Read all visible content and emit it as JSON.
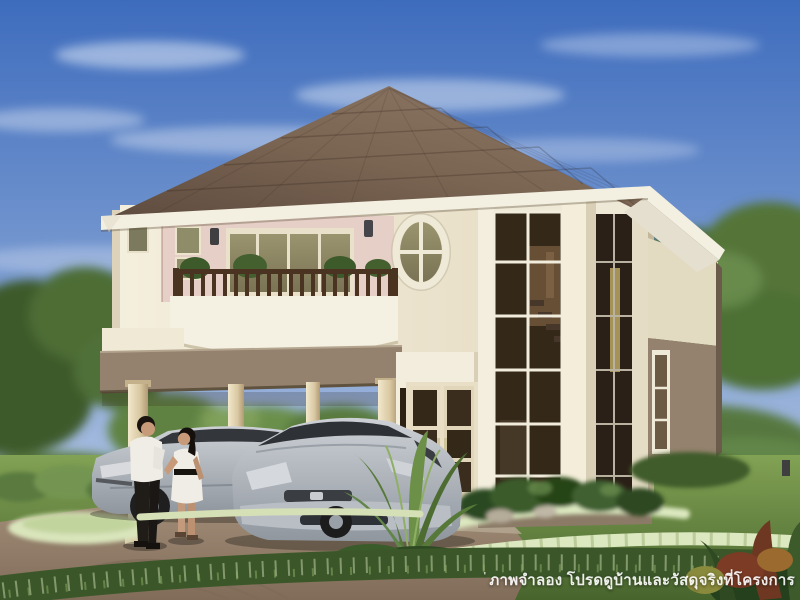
{
  "watermark": {
    "mark": "'",
    "text": "ภาพจำลอง โปรดดูบ้านและวัสดุจริงที่โครงการ"
  },
  "scene": {
    "setting": "Daytime exterior rendering of a two-story detached house with carport",
    "objects": {
      "sky": "blue sky with thin white clouds",
      "roof": "brown hipped tile roof with white fascia and eaves",
      "upper-walls": "cream walls with pink balcony recess",
      "lower-walls": "taupe stucco base",
      "balcony": "white curved parapet with dark wood railing and potted plants",
      "oval-window": "oval window with white cross muntins",
      "corner-window-bay": "two-story chamfered corner bay with dark glazing and visible staircase",
      "carport": "flat-roof carport on round cream columns",
      "front-door": "double doors with dark glass panes",
      "sedan-car": "silver sedan parked under carport",
      "hatchback-car": "silver hatchback parked in driveway",
      "man": "man in white shirt and black trousers",
      "woman": "woman in white dress with black belt",
      "garden": "lawn, trimmed hedges, white flower borders, palm and tropical plants",
      "trees": "green trees surrounding the property"
    }
  },
  "palette": {
    "sky-top": "#3e6cbd",
    "sky-mid": "#84a3d4",
    "sky-low": "#c9d6ea",
    "cloud-white": "#eef3fb",
    "roof-dark": "#554439",
    "roof-mid": "#7a6452",
    "roof-light": "#8d7765",
    "fascia-white": "#f3efe1",
    "wall-cream": "#f1ead7",
    "wall-cream-shade": "#ddd3bb",
    "wall-pink": "#e6cfc6",
    "wall-taupe": "#94826e",
    "wall-taupe-dark": "#7d6c5a",
    "column-cream": "#ecdfbe",
    "glass-olive": "#8f8c6a",
    "glass-dark": "#342819",
    "glass-stair": "#6b5338",
    "rail-wood": "#4b3322",
    "lawn-light": "#82a254",
    "lawn-dark": "#47642d",
    "tree-dark": "#3c5a2a",
    "tree-mid": "#52723a",
    "tree-light": "#6f924c",
    "drive-light": "#a18d78",
    "drive-dark": "#806c58",
    "flower-white": "#dce8c0",
    "car-silver-light": "#cdd1d6",
    "car-silver-dark": "#8f969e",
    "glass-car": "#33373b",
    "skin-tone": "#c79b79",
    "shirt-white": "#efede5",
    "pants-black": "#201d19",
    "watermark-white": "#ffffff"
  }
}
